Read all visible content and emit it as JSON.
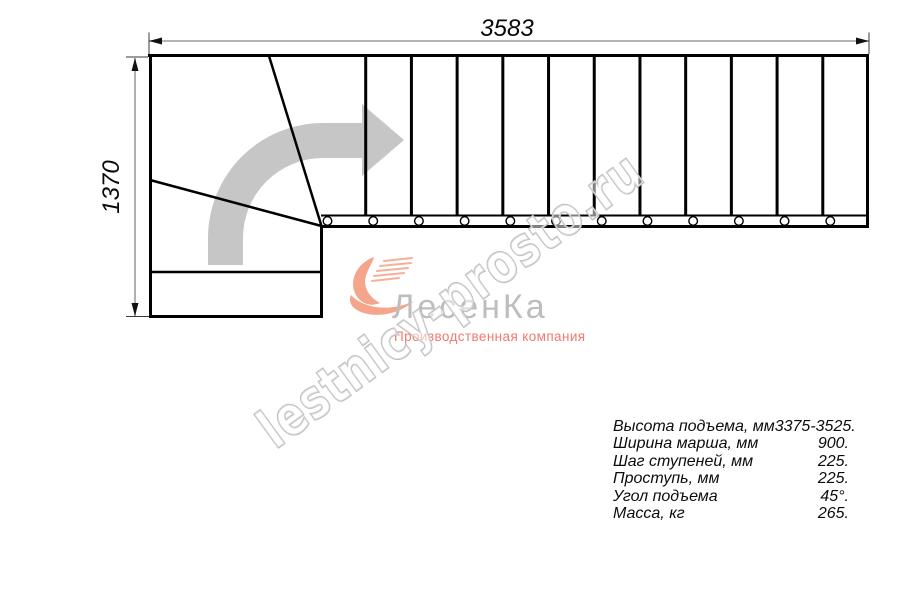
{
  "drawing": {
    "title": "staircase-plan-top-view",
    "dim_width": "3583",
    "dim_height": "1370",
    "plan": {
      "tread_count": 12,
      "bolt_count": 12
    },
    "colors": {
      "line": "#000000",
      "dimension_line": "#9c9c9c",
      "direction_arrow": "#c6c6c6"
    }
  },
  "logo": {
    "name": "ЛесенКа",
    "tagline": "Производственная компания",
    "accent_color": "#f5a58c",
    "name_color": "#bdbdbd",
    "tagline_color": "#f2796d"
  },
  "watermark": {
    "text": "lestnicy-prosto.ru"
  },
  "specs": {
    "rows": [
      {
        "label": "Высота подъема, мм",
        "value": "3375-3525."
      },
      {
        "label": "Ширина марша, мм",
        "value": "900."
      },
      {
        "label": "Шаг ступеней, мм",
        "value": "225."
      },
      {
        "label": "Проступь, мм",
        "value": "225."
      },
      {
        "label": "Угол подъема",
        "value": "45°."
      },
      {
        "label": "Масса, кг",
        "value": "265."
      }
    ]
  }
}
